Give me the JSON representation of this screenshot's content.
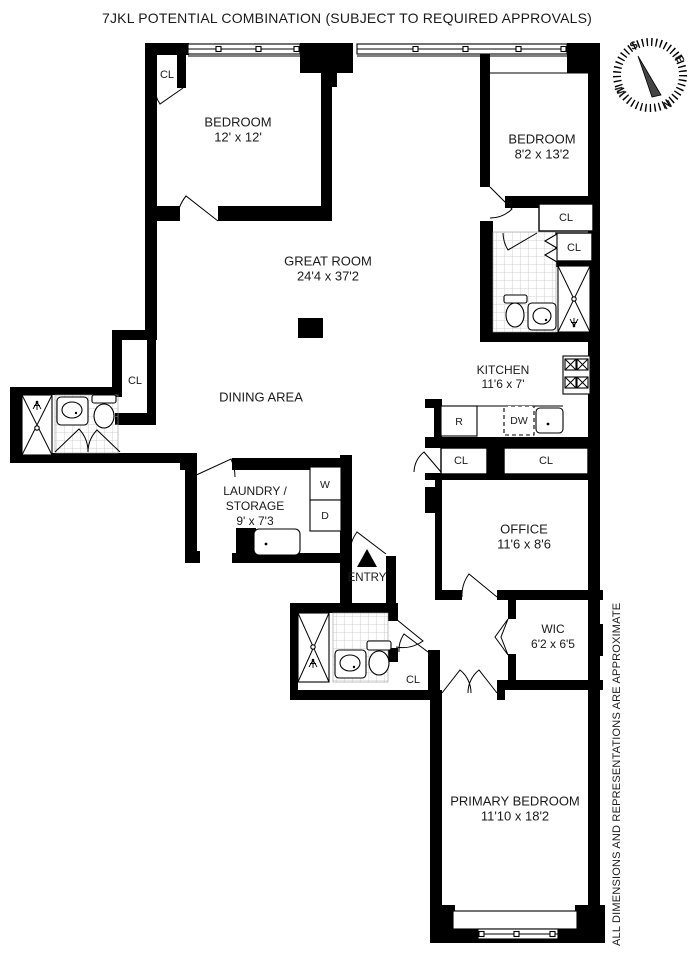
{
  "title": "7JKL POTENTIAL COMBINATION (SUBJECT TO REQUIRED APPROVALS)",
  "disclaimer": "ALL DIMENSIONS AND REPRESENTATIONS ARE APPROXIMATE",
  "compass": {
    "north": "N",
    "south": "S",
    "east": "E",
    "west": "W"
  },
  "labels": {
    "closet": "CL",
    "entry": "ENTRY"
  },
  "appliances": {
    "refrigerator": "R",
    "dishwasher": "DW",
    "washer": "W",
    "dryer": "D"
  },
  "rooms": {
    "bedroom1": {
      "name": "BEDROOM",
      "dims": "12' x 12'"
    },
    "bedroom2": {
      "name": "BEDROOM",
      "dims": "8'2 x 13'2"
    },
    "great_room": {
      "name": "GREAT ROOM",
      "dims": "24'4 x 37'2"
    },
    "dining_area": {
      "name": "DINING AREA"
    },
    "kitchen": {
      "name": "KITCHEN",
      "dims": "11'6 x 7'"
    },
    "laundry_storage": {
      "name_line1": "LAUNDRY /",
      "name_line2": "STORAGE",
      "dims": "9' x 7'3"
    },
    "office": {
      "name": "OFFICE",
      "dims": "11'6 x 8'6"
    },
    "wic": {
      "name": "WIC",
      "dims": "6'2 x 6'5"
    },
    "primary_bedroom": {
      "name": "PRIMARY BEDROOM",
      "dims": "11'10 x 18'2"
    }
  }
}
